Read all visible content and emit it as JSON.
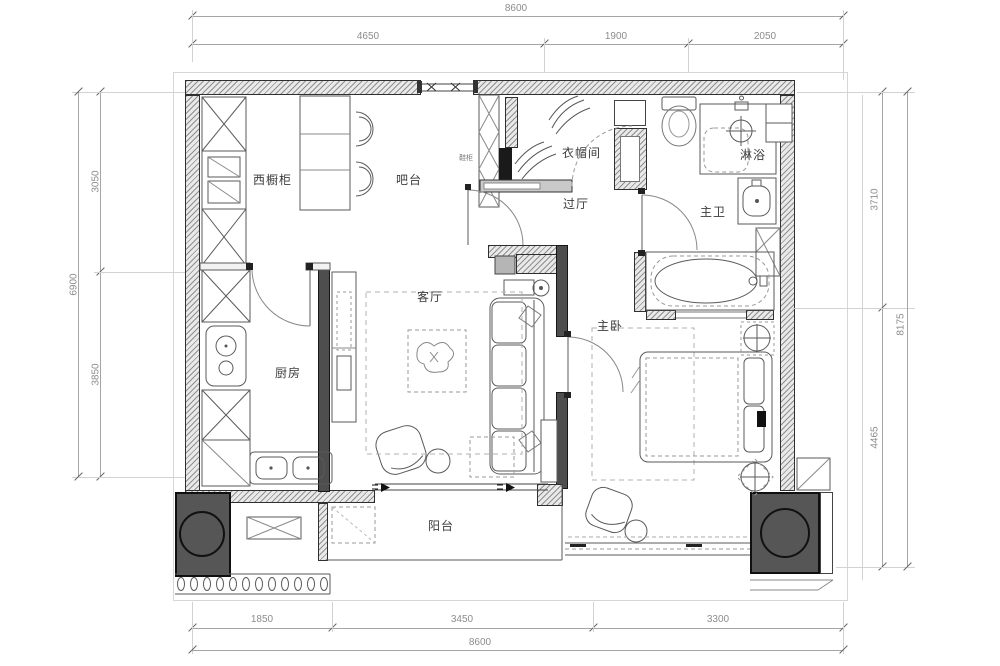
{
  "plan_labels": {
    "west_cabinet": "西橱柜",
    "bar": "吧台",
    "shoe_cabinet": "鞋柜",
    "cloakroom": "衣帽间",
    "hall": "过厅",
    "master_bath": "主卫",
    "shower": "淋浴",
    "kitchen": "厨房",
    "living_room": "客厅",
    "master_bedroom": "主卧",
    "balcony": "阳台"
  },
  "dimensions": {
    "top": {
      "total": "8600",
      "segments": [
        "4650",
        "1900",
        "2050"
      ]
    },
    "bottom": {
      "total": "8600",
      "segments": [
        "1850",
        "3450",
        "3300"
      ]
    },
    "left": {
      "total": "6900",
      "segments": [
        "3050",
        "3850"
      ]
    },
    "right": {
      "total": "8175",
      "segments": [
        "3710",
        "4465"
      ]
    }
  },
  "colors": {
    "wall_fill": "#e9e9e9",
    "wall_hatch": "#8f8f8f",
    "dark_block": "#565656",
    "line": "#5a5a5a",
    "dim_text": "#8c8c8c",
    "label_text": "#3c3c3c"
  }
}
